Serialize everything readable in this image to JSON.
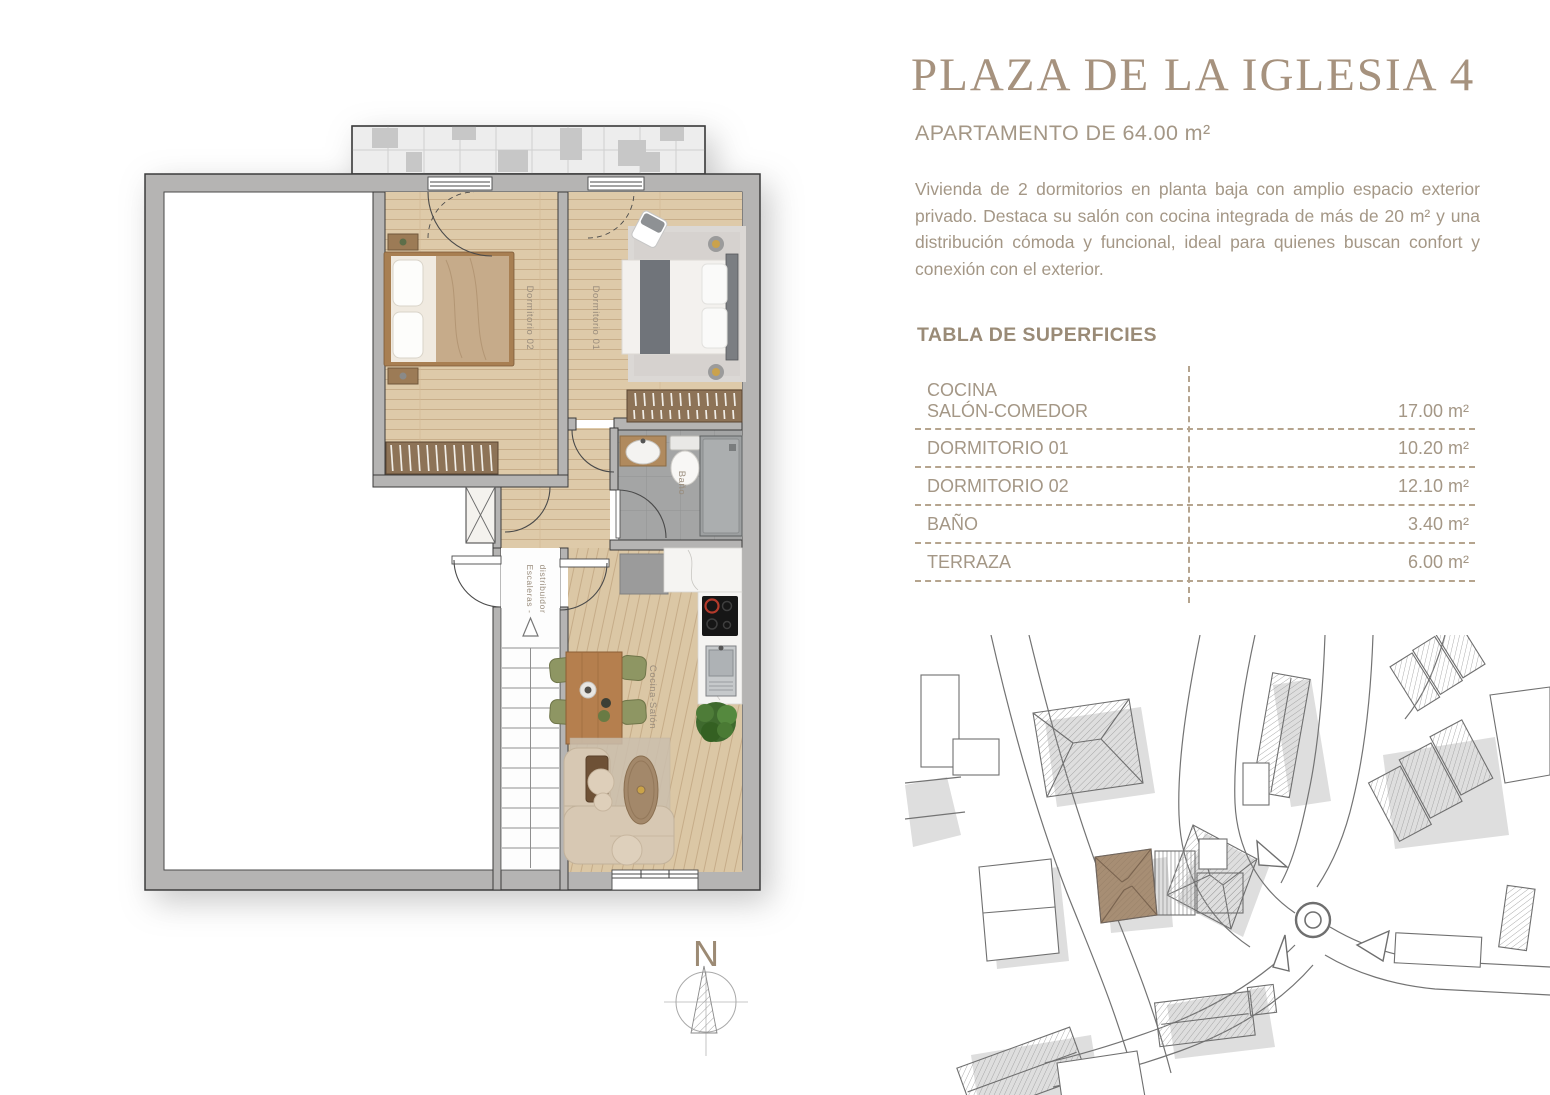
{
  "header": {
    "title": "PLAZA DE LA IGLESIA 4",
    "subtitle": "APARTAMENTO DE 64.00 m²"
  },
  "description": "Vivienda de 2 dormitorios en planta baja con amplio espacio exterior privado. Destaca su salón con cocina integrada de más de 20 m² y una distribución cómoda y funcional, ideal para quienes buscan confort y conexión con el exterior.",
  "surfaces": {
    "heading": "TABLA DE SUPERFICIES",
    "first_row": {
      "label_line1": "COCINA",
      "label_line2": "SALÓN-COMEDOR",
      "value": "17.00 m²"
    },
    "rows": [
      {
        "label": "DORMITORIO 01",
        "value": "10.20 m²"
      },
      {
        "label": "DORMITORIO 02",
        "value": "12.10 m²"
      },
      {
        "label": "BAÑO",
        "value": "3.40 m²"
      },
      {
        "label": "TERRAZA",
        "value": "6.00 m²"
      }
    ]
  },
  "floor_plan": {
    "labels": {
      "dormitorio_02": "Dormitorio 02",
      "dormitorio_01": "Dormitorio 01",
      "bano": "Baño",
      "escaleras_line1": "Escaleras -",
      "escaleras_line2": "distribuidor",
      "cocina_salon": "Cocina-Salón"
    },
    "compass_north": "N"
  },
  "site_map": {
    "highlight_color": "#a78e74"
  },
  "colors": {
    "accent_taupe": "#a6927e",
    "body_text": "#a49786",
    "table_dash": "#b5a48e",
    "wall_gray": "#b5b4b3",
    "wood": "#decaa9"
  }
}
